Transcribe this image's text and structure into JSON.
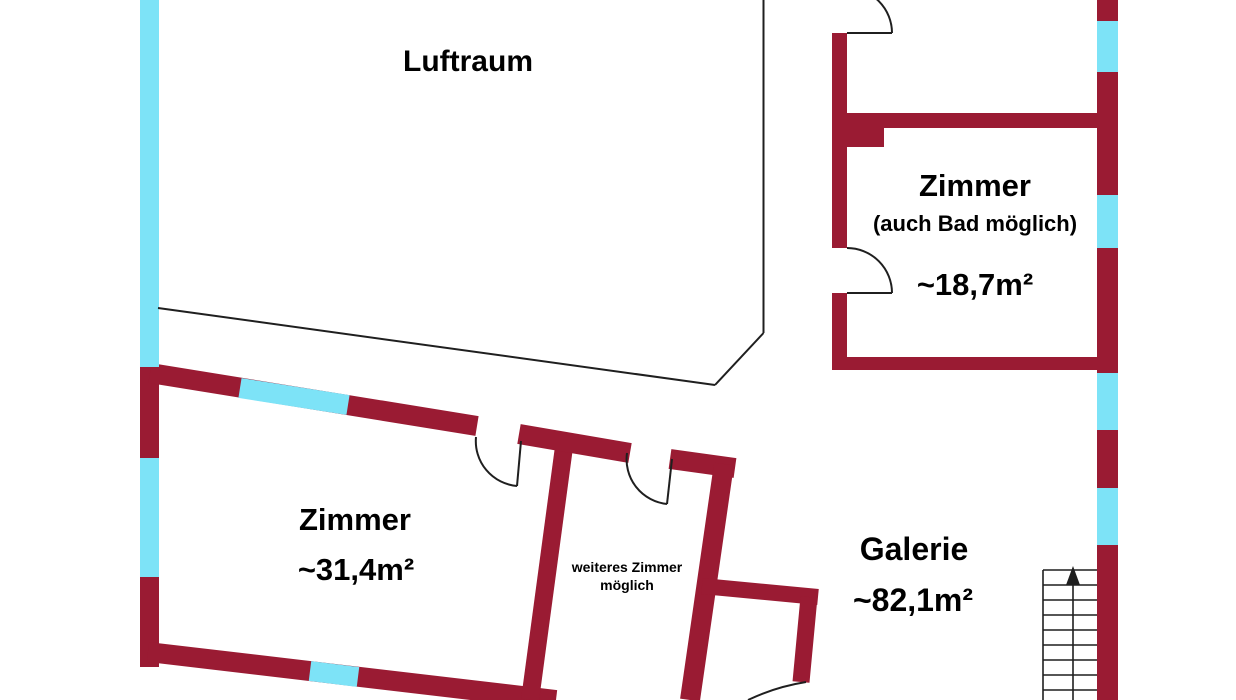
{
  "plan": {
    "type": "floor-plan",
    "colors": {
      "wall": "#9a1b33",
      "window": "#7de3f7",
      "line": "#1f1f1f",
      "text": "#000000",
      "background": "#ffffff"
    },
    "labels": {
      "luftraum": "Luftraum",
      "zimmer_bad": {
        "name": "Zimmer",
        "subtitle": "(auch Bad möglich)",
        "area": "~18,7m²"
      },
      "zimmer_31": {
        "name": "Zimmer",
        "area": "~31,4m²"
      },
      "weiteres_zimmer": {
        "line1": "weiteres Zimmer",
        "line2": "möglich"
      },
      "galerie": {
        "name": "Galerie",
        "area": "~82,1m²"
      }
    },
    "stairs": {
      "icon": "up-arrow",
      "treads": 9
    }
  }
}
